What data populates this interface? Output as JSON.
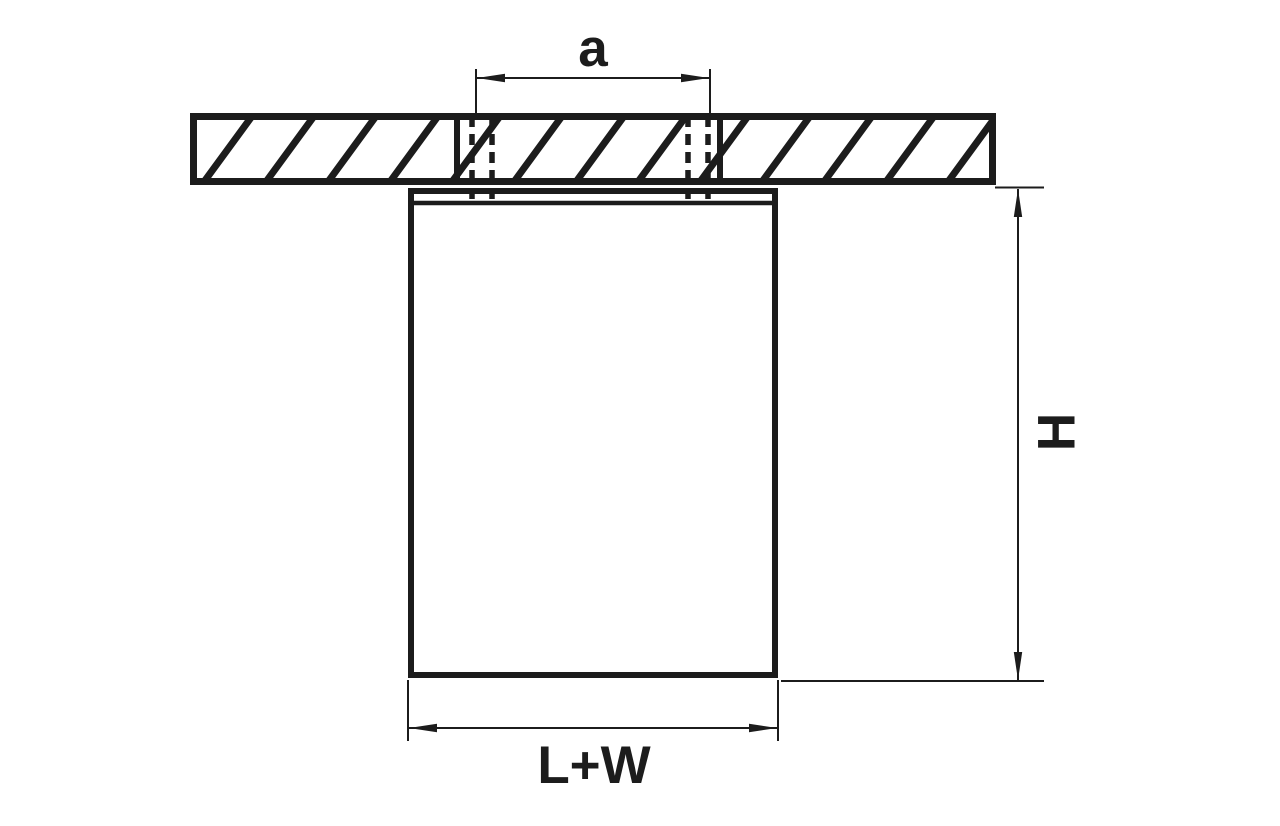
{
  "drawing": {
    "labels": {
      "screw_spacing": "a",
      "height": "H",
      "width": "L+W"
    },
    "colors": {
      "line": "#1c1c1c",
      "background": "#ffffff"
    }
  }
}
